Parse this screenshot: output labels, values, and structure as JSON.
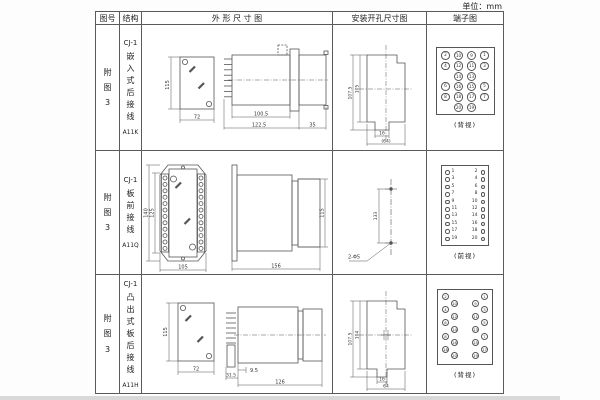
{
  "unit_label": "单位：mm",
  "table_header": {
    "figure_col": "图号",
    "structure_col": "结构",
    "outline_col": "外 形 尺 寸 图",
    "mounting_col": "安装开孔尺寸图",
    "terminal_col": "端子图"
  },
  "rows": [
    {
      "figure_no": "附图3",
      "model": "CJ-1",
      "structure_type": "嵌入式后接线",
      "code": "A11K",
      "outline": {
        "height": "115",
        "width": "72",
        "depth": "100.5",
        "total_depth": "122.5",
        "flange": "35"
      },
      "mounting": {
        "outer_height": "107.5",
        "inner_height": "105",
        "slot_width": "16",
        "opening_width": "(64)"
      },
      "terminal": {
        "view": "(背视)",
        "style": "grid4",
        "rows": [
          [
            "2",
            "10",
            "9",
            "1"
          ],
          [
            "4",
            "12",
            "11",
            "3"
          ],
          [
            "",
            "14",
            "13",
            ""
          ],
          [
            "6",
            "16",
            "15",
            "5"
          ],
          [
            "8",
            "18",
            "17",
            "7"
          ],
          [
            "",
            "20",
            "19",
            ""
          ]
        ]
      }
    },
    {
      "figure_no": "附图3",
      "model": "CJ-1",
      "structure_type": "板前接线",
      "code": "A11Q",
      "outline": {
        "outer_height": "140",
        "inner_height": "125",
        "width": "105",
        "depth": "156",
        "body_height": "115"
      },
      "mounting": {
        "hole_spacing": "133",
        "holes_label": "2-Φ5"
      },
      "terminal": {
        "view": "(前视)",
        "style": "pairs",
        "rows": [
          [
            "1",
            "2"
          ],
          [
            "3",
            "4"
          ],
          [
            "5",
            "6"
          ],
          [
            "7",
            "8"
          ],
          [
            "9",
            "10"
          ],
          [
            "11",
            "12"
          ],
          [
            "13",
            "14"
          ],
          [
            "15",
            "16"
          ],
          [
            "17",
            "18"
          ],
          [
            "19",
            "20"
          ]
        ]
      }
    },
    {
      "figure_no": "附图3",
      "model": "CJ-1",
      "structure_type": "凸出式板后接线",
      "code": "A11H",
      "outline": {
        "height": "115",
        "width": "72",
        "stud": "9.5",
        "base": "31.5",
        "depth": "126"
      },
      "mounting": {
        "outer_height": "107.5",
        "inner_height": "104",
        "slot_width": "16",
        "opening_width": "64"
      },
      "terminal": {
        "view": "(背视)",
        "style": "staggered",
        "left": [
          "2",
          "10",
          "4",
          "12",
          "6",
          "14",
          "8",
          "16",
          "18",
          "20"
        ],
        "right": [
          "1",
          "9",
          "3",
          "11",
          "5",
          "13",
          "7",
          "15",
          "17",
          "19"
        ]
      }
    }
  ]
}
